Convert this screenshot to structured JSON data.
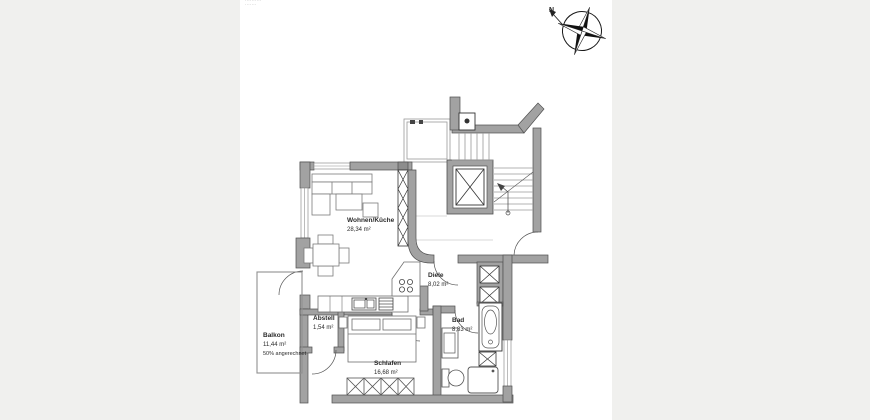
{
  "stamp": {
    "line1": "··········",
    "line2": "·······"
  },
  "compass": {
    "north_label": "N"
  },
  "rooms": {
    "wohnen": {
      "name": "Wohnen/Küche",
      "area": "28,34 m²"
    },
    "diele": {
      "name": "Diele",
      "area": "8,02 m²"
    },
    "abstell": {
      "name": "Abstell",
      "area": "1,54 m²"
    },
    "bad": {
      "name": "Bad",
      "area": "8,83 m²"
    },
    "schlafen": {
      "name": "Schlafen",
      "area": "16,68 m²"
    },
    "balkon": {
      "name": "Balkon",
      "area": "11,44 m²",
      "note": "50% angerechnet"
    }
  },
  "colors": {
    "wall": "#a2a2a2",
    "wall_edge": "#4f4f4f",
    "paper": "#ffffff",
    "canvas_bg": "#f0f0ee",
    "thin_line": "#8f8f8f"
  }
}
